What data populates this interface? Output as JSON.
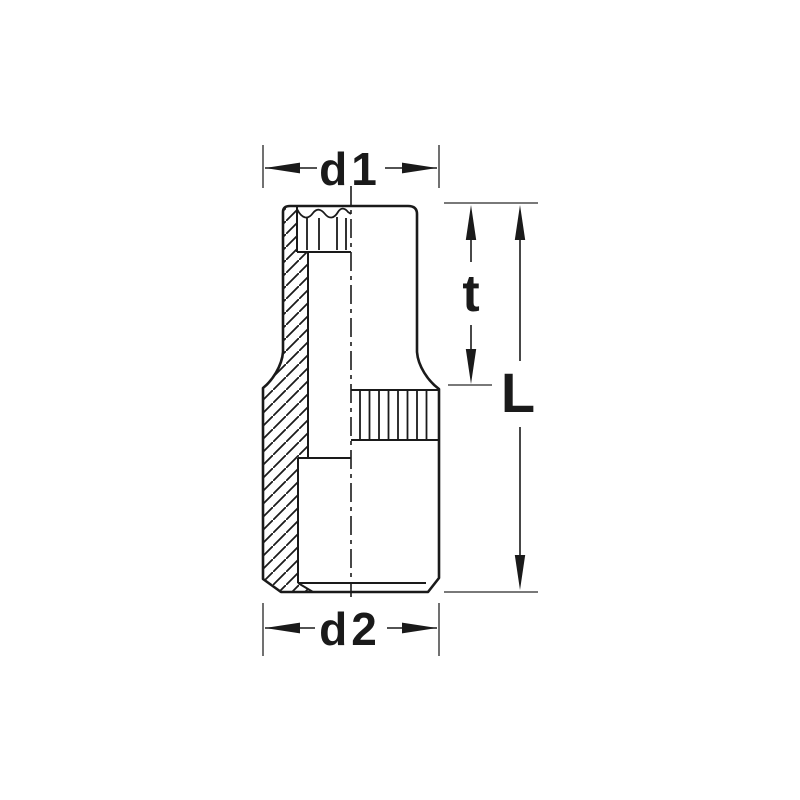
{
  "diagram": {
    "kind": "technical-dimension-drawing",
    "labels": {
      "d1": "d1",
      "d2": "d2",
      "t": "t",
      "L": "L"
    },
    "colors": {
      "background": "#ffffff",
      "line": "#1a1a1a",
      "extension_line": "#4d4d4d"
    }
  }
}
